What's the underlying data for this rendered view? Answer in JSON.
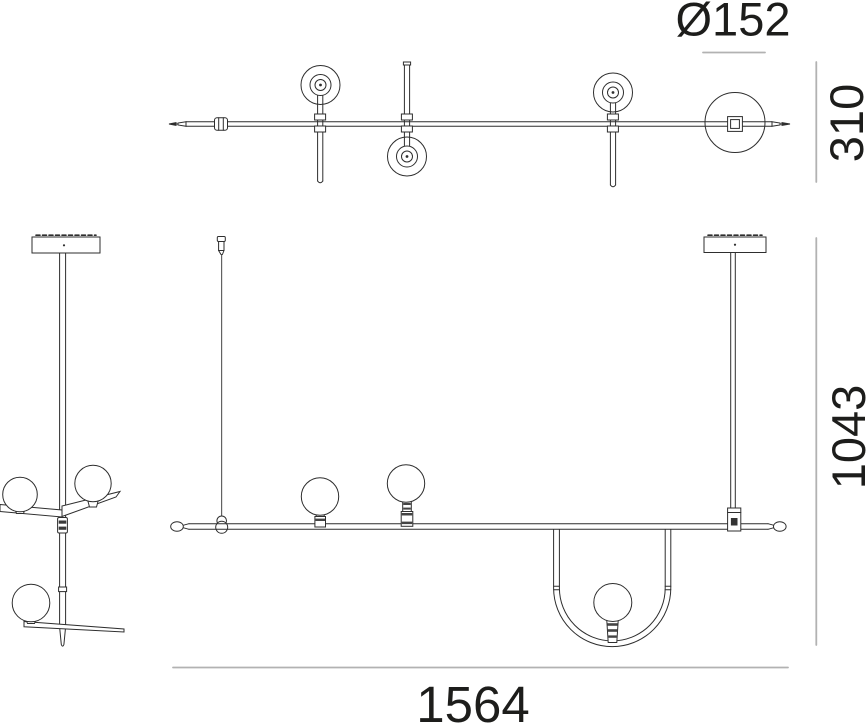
{
  "drawing": {
    "type": "technical-dimension-drawing",
    "subject": "suspension-lamp plan, side and front elevation views",
    "colors": {
      "line": "#2e2e2e",
      "dimension_line": "#b2b2b2",
      "text": "#1d1d1b",
      "background": "#ffffff"
    },
    "dimensions": {
      "sphere_diameter": "Ø152",
      "plan_depth": "310",
      "suspension_height": "1043",
      "overall_width": "1564"
    }
  }
}
